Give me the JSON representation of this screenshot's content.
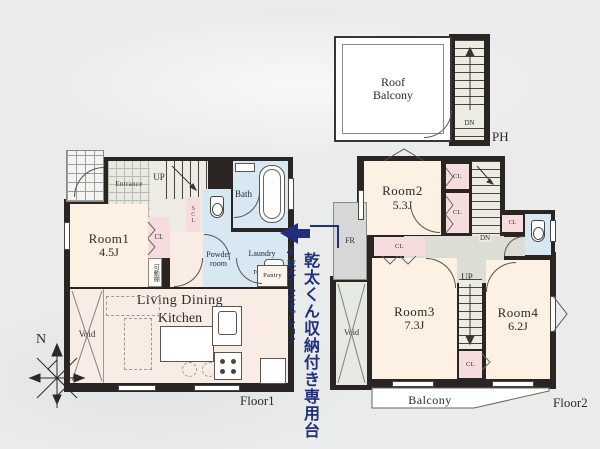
{
  "shared": {
    "cl": "CL",
    "up": "UP",
    "dn": "DN",
    "void": "Void"
  },
  "compass": {
    "north": "N"
  },
  "annotation": {
    "headline": "乾太くん収納付き専用台",
    "note": "※乾太くんはオプション",
    "accent_color": "#20307f"
  },
  "floor1": {
    "name": "Floor1",
    "entrance": "Entrance",
    "shoe_closet": "SCL",
    "bath": "Bath",
    "room1": {
      "name": "Room1",
      "size": "4.5J"
    },
    "movable_shelf": "可動棚",
    "powder": {
      "line1": "Powder",
      "line2": "room"
    },
    "laundry": {
      "line1": "Laundry",
      "line2": "room"
    },
    "pantry": "Pantry",
    "ldk": {
      "line1": "Living Dining",
      "line2": "Kitchen",
      "size": "17.5J"
    }
  },
  "floor2": {
    "name": "Floor2",
    "ph": "PH",
    "roof_balcony": {
      "line1": "Roof",
      "line2": "Balcony"
    },
    "room2": {
      "name": "Room2",
      "size": "5.3J"
    },
    "room3": {
      "name": "Room3",
      "size": "7.3J"
    },
    "room4": {
      "name": "Room4",
      "size": "6.2J"
    },
    "fr": "FR",
    "balcony": "Balcony"
  },
  "colors": {
    "wall": "#2a2422",
    "room_cream": "#fcf1e2",
    "closet_pink": "#f6dddd",
    "wet_blue": "#d8e8f2",
    "hall_gray": "#dcded6",
    "void_green": "#e4eae1",
    "accent_blue": "#20307f"
  }
}
